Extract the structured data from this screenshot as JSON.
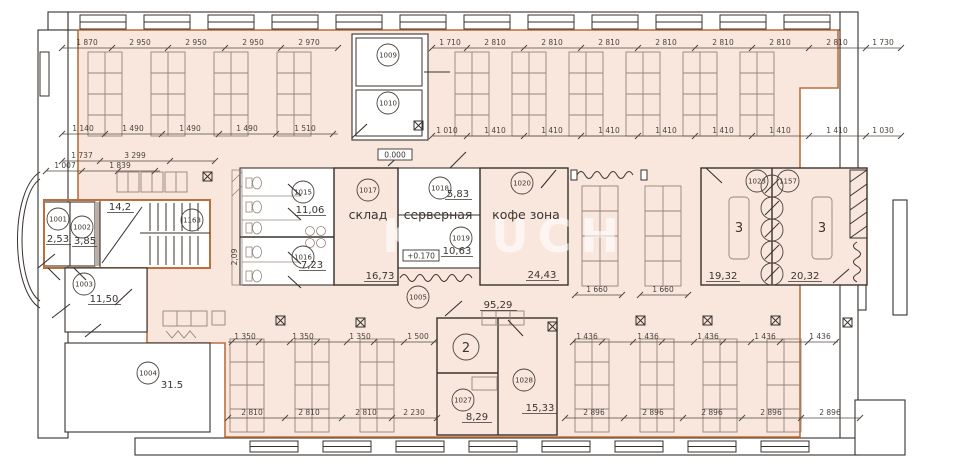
{
  "colors": {
    "floor_fill": "#f9e7de",
    "accent_wall": "#bc6f3c"
  },
  "watermark": "KLIUCH",
  "levels": {
    "ground": "0.000",
    "server": "+0.170"
  },
  "rooms": {
    "r1001": {
      "num": "1001",
      "area": "2,53"
    },
    "r1002": {
      "num": "1002",
      "area": "3,85"
    },
    "r1003": {
      "num": "1003",
      "area": "11,50"
    },
    "r1004": {
      "num": "1004",
      "area": "31.5"
    },
    "r1005": {
      "num": "1005",
      "area": "95,29"
    },
    "r1009": {
      "num": "1009"
    },
    "r1010": {
      "num": "1010"
    },
    "r1015": {
      "num": "1015",
      "area": "11,06"
    },
    "r1016": {
      "num": "1016",
      "area": "7,23"
    },
    "r1017": {
      "num": "1017",
      "area": "16,73",
      "name": "склад"
    },
    "r1018": {
      "num": "1018",
      "area": "5,83"
    },
    "r1019": {
      "num": "1019",
      "area": "10,63",
      "name": "серверная"
    },
    "r1020": {
      "num": "1020",
      "area": "24,43",
      "name": "кофе зона"
    },
    "r1023": {
      "num": "1023",
      "area": "19,32",
      "label": "3"
    },
    "r1157": {
      "num": "1157",
      "area": "20,32",
      "label": "3"
    },
    "r1163": {
      "num": "1163",
      "area": "14,2"
    },
    "r1027": {
      "num": "1027",
      "area": "8,29"
    },
    "r1028": {
      "num": "1028",
      "area": "15,33"
    },
    "stair2": {
      "num": "2"
    }
  },
  "dims": {
    "t1l": [
      "1 870",
      "2 950",
      "2 950",
      "2 950",
      "2 970"
    ],
    "t1r": [
      "1 710",
      "2 810",
      "2 810",
      "2 810",
      "2 810",
      "2 810",
      "2 810",
      "2 810",
      "1 730"
    ],
    "t2l": [
      "1 140",
      "1 490",
      "1 490",
      "1 490",
      "1 510"
    ],
    "t2r": [
      "1 010",
      "1 410",
      "1 410",
      "1 410",
      "1 410",
      "1 410",
      "1 410",
      "1 410",
      "1 030"
    ],
    "lx": [
      "1 737",
      "3 299",
      "1 007",
      "1 839"
    ],
    "mid": [
      "1 660",
      "1 660"
    ],
    "b1l": [
      "1 350",
      "1 350",
      "1 350",
      "1 500"
    ],
    "b1r": [
      "1 436",
      "1 436",
      "1 436",
      "1 436",
      "1 436"
    ],
    "b2l": [
      "2 810",
      "2 810",
      "2 810",
      "2 230"
    ],
    "b2r": [
      "2 896",
      "2 896",
      "2 896",
      "2 896",
      "2 896"
    ],
    "wc_side": "2,09"
  }
}
